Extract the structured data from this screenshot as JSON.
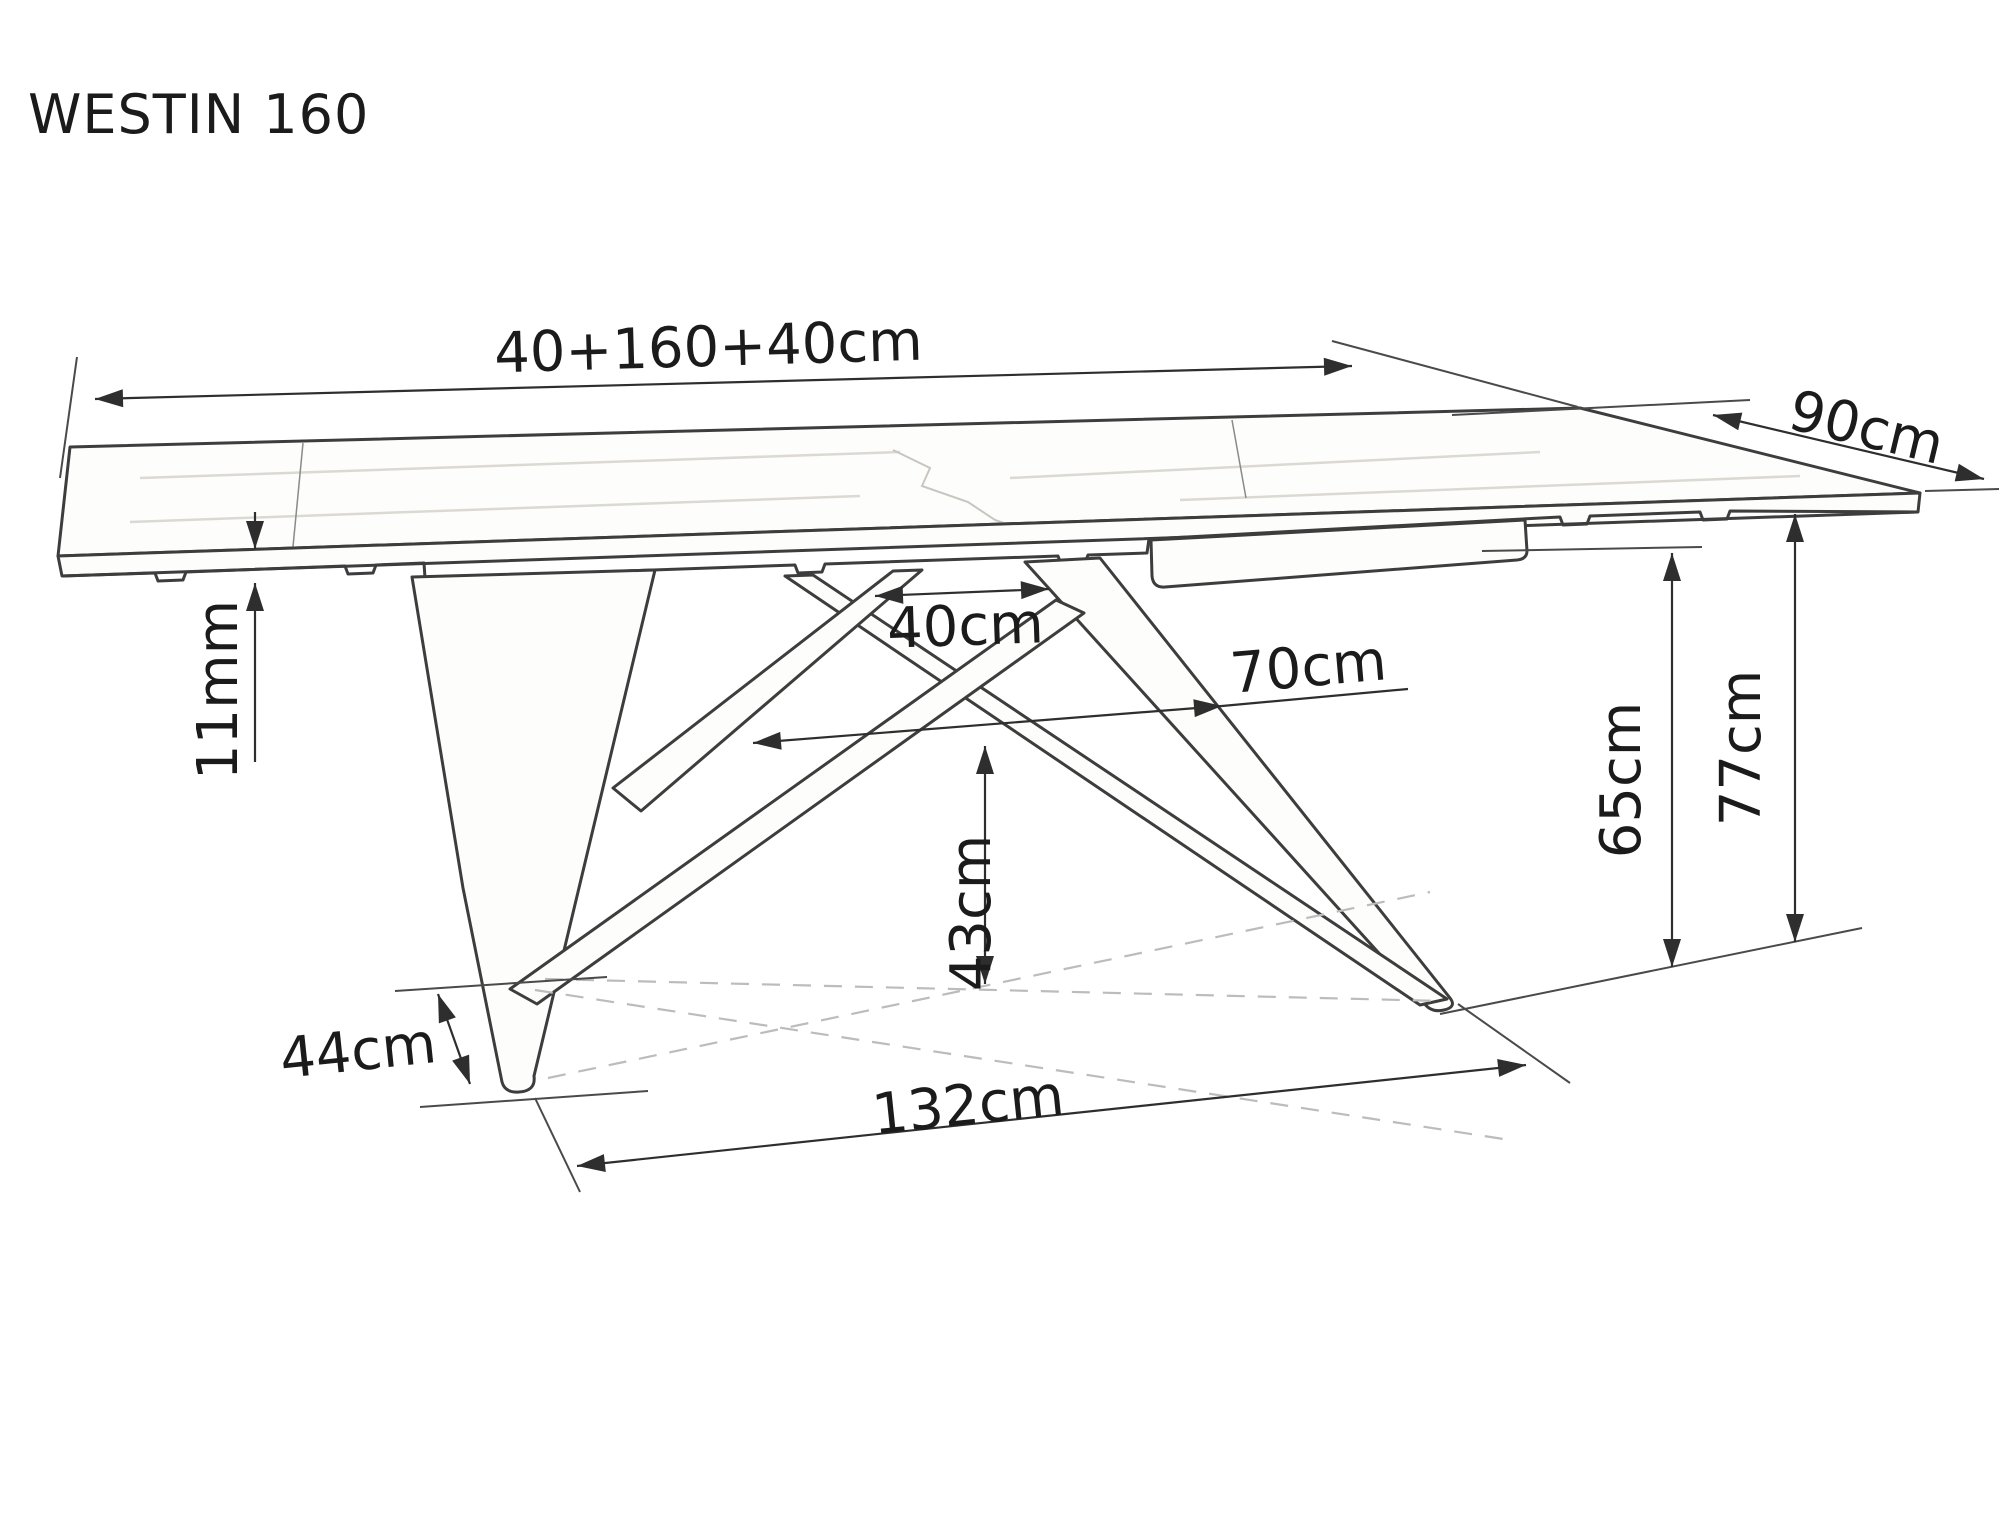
{
  "title": "WESTIN 160",
  "drawing": {
    "type": "furniture-dimension-diagram",
    "object": "extendable dining table, perspective view"
  },
  "dimensions": {
    "total_width": "40+160+40cm",
    "depth": "90cm",
    "top_thickness": "11mm",
    "base_top_opening": "40cm",
    "base_mid_span": "70cm",
    "underframe_clearance": "65cm",
    "table_height": "77cm",
    "base_cross_height": "43cm",
    "foot_depth": "44cm",
    "base_length": "132cm"
  },
  "colors": {
    "background": "#ffffff",
    "line": "#3d3d3d",
    "dimension_line": "#2e2e2e",
    "text": "#1b1b1b",
    "dashed_reference": "#bcbcbc"
  }
}
